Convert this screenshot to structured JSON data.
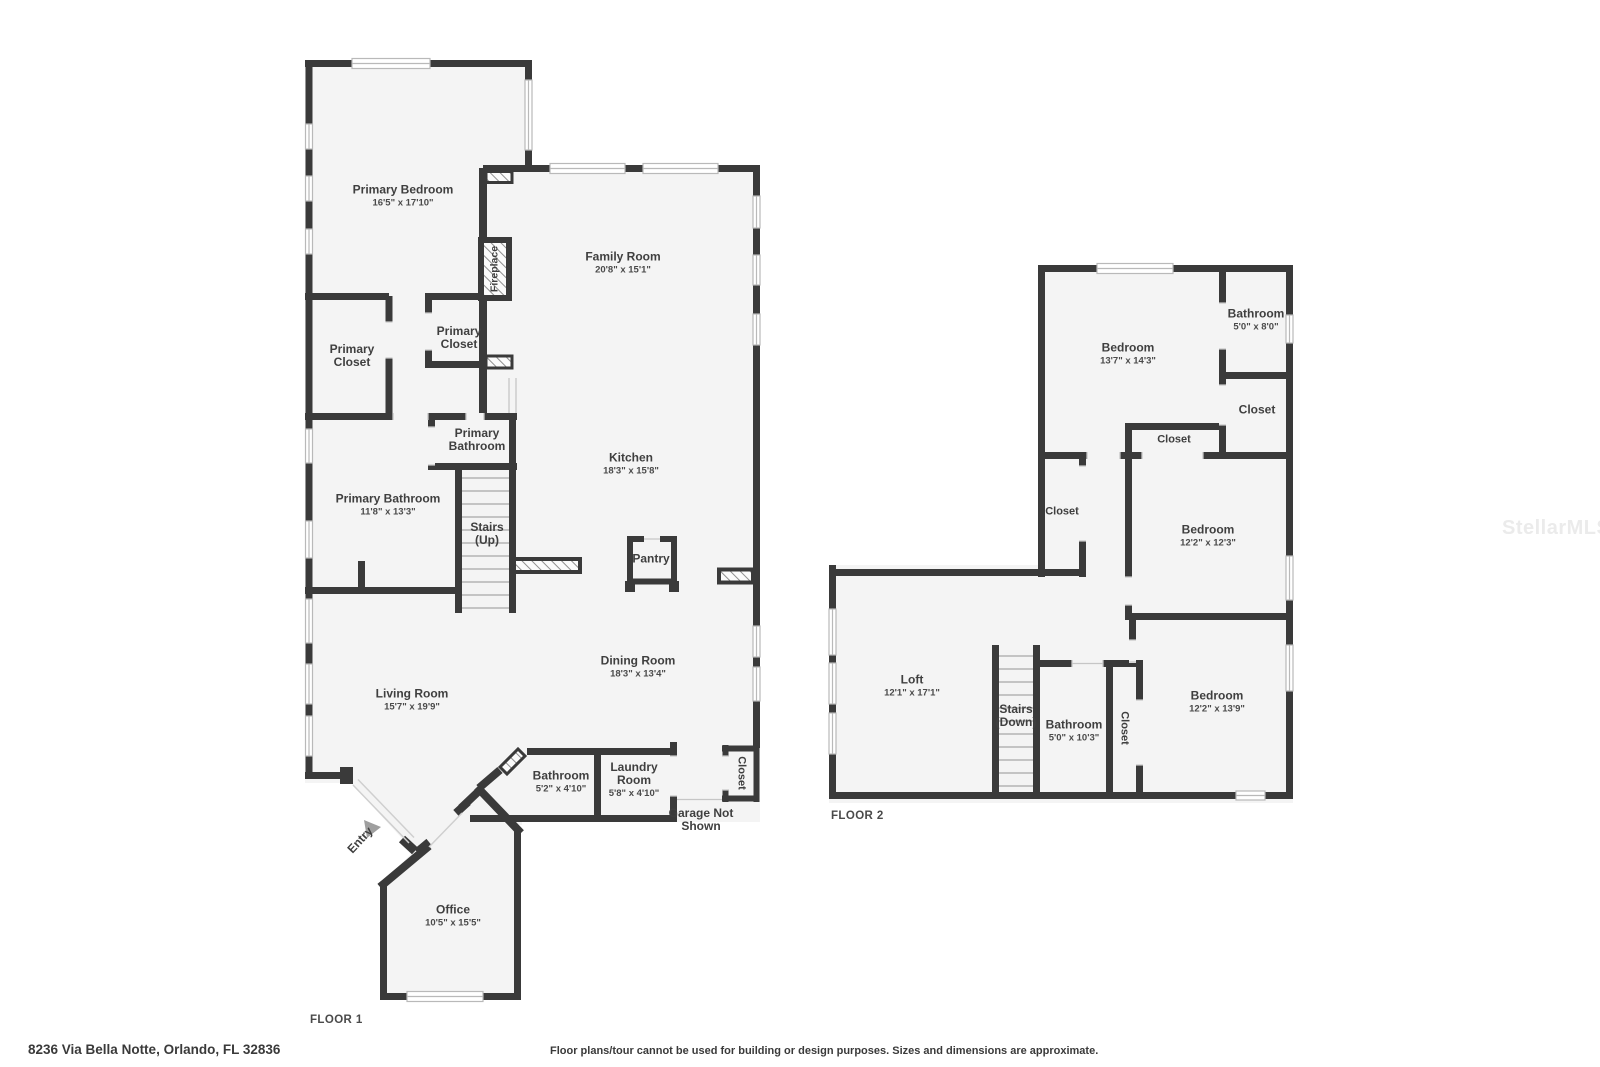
{
  "footer": {
    "address": "8236 Via Bella Notte, Orlando, FL 32836",
    "disclaimer": "Floor plans/tour cannot be used for building or design purposes. Sizes and dimensions are approximate."
  },
  "watermark": {
    "text": "StellarMLS"
  },
  "floor1": {
    "label": "FLOOR 1",
    "rooms": [
      {
        "name": "Primary Bedroom",
        "dims": "16'5\" x 17'10\""
      },
      {
        "name": "Family Room",
        "dims": "20'8\" x 15'1\""
      },
      {
        "name": "Primary Closet"
      },
      {
        "name": "Primary Closet"
      },
      {
        "name": "Fireplace"
      },
      {
        "name": "Primary Bathroom"
      },
      {
        "name": "Primary Bathroom",
        "dims": "11'8\" x 13'3\""
      },
      {
        "name": "Stairs (Up)"
      },
      {
        "name": "Kitchen",
        "dims": "18'3\" x 15'8\""
      },
      {
        "name": "Pantry"
      },
      {
        "name": "Dining Room",
        "dims": "18'3\" x 13'4\""
      },
      {
        "name": "Living Room",
        "dims": "15'7\" x 19'9\""
      },
      {
        "name": "Bathroom",
        "dims": "5'2\" x 4'10\""
      },
      {
        "name": "Laundry Room",
        "dims": "5'8\" x 4'10\""
      },
      {
        "name": "Closet"
      },
      {
        "name": "Garage Not Shown"
      },
      {
        "name": "Entry"
      },
      {
        "name": "Office",
        "dims": "10'5\" x 15'5\""
      }
    ]
  },
  "floor2": {
    "label": "FLOOR 2",
    "rooms": [
      {
        "name": "Bedroom",
        "dims": "13'7\" x 14'3\""
      },
      {
        "name": "Bathroom",
        "dims": "5'0\" x 8'0\""
      },
      {
        "name": "Closet"
      },
      {
        "name": "Closet"
      },
      {
        "name": "Closet"
      },
      {
        "name": "Bedroom",
        "dims": "12'2\" x 12'3\""
      },
      {
        "name": "Loft",
        "dims": "12'1\" x 17'1\""
      },
      {
        "name": "Stairs (Down)"
      },
      {
        "name": "Bathroom",
        "dims": "5'0\" x 10'3\""
      },
      {
        "name": "Closet"
      },
      {
        "name": "Bedroom",
        "dims": "12'2\" x 13'9\""
      }
    ]
  }
}
